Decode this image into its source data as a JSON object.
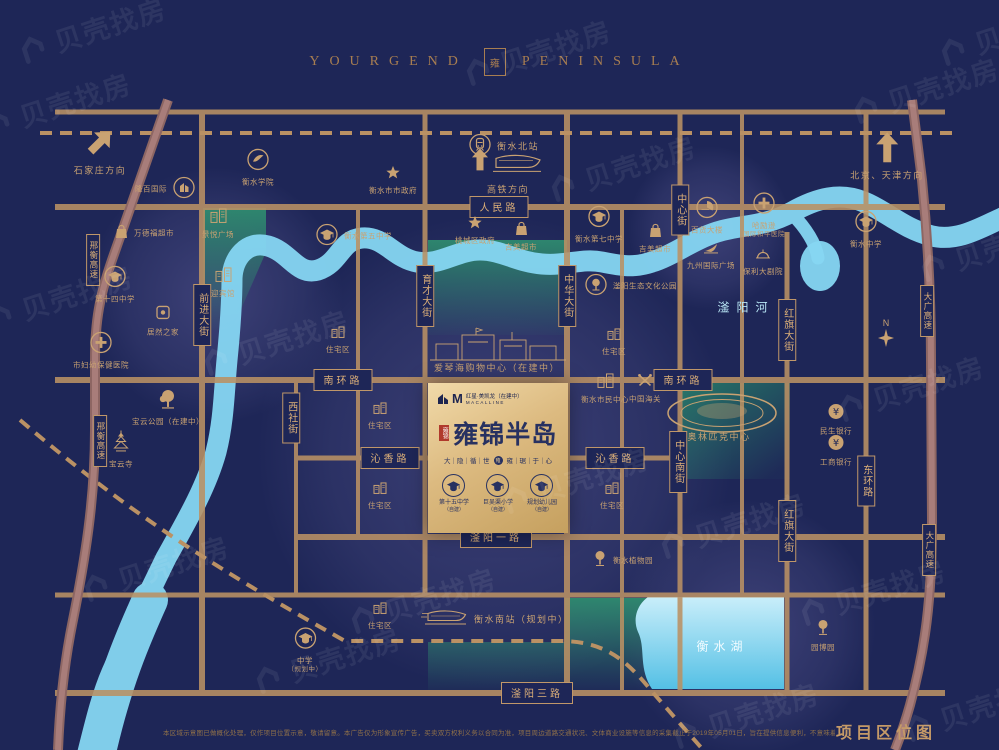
{
  "header": {
    "brand_left": "YOURGEND",
    "seal": "雍",
    "brand_right": "PENINSULA"
  },
  "watermark": {
    "text": "贝壳找房"
  },
  "labels": {
    "river": "滏阳河",
    "lake": "衡水湖",
    "compass_n": "N"
  },
  "roads": {
    "horizontal": [
      {
        "id": "renmin-road",
        "text": "人民路",
        "x": 499,
        "y": 207
      },
      {
        "id": "nanhuan-road-west",
        "text": "南环路",
        "x": 343,
        "y": 380
      },
      {
        "id": "nanhuan-road-east",
        "text": "南环路",
        "x": 683,
        "y": 380
      },
      {
        "id": "qinxiang-road-west",
        "text": "沁香路",
        "x": 390,
        "y": 458
      },
      {
        "id": "qinxiang-road-east",
        "text": "沁香路",
        "x": 615,
        "y": 458
      },
      {
        "id": "fuyang-1st-road",
        "text": "滏阳一路",
        "x": 496,
        "y": 537
      },
      {
        "id": "fuyang-3rd-road",
        "text": "滏阳三路",
        "x": 537,
        "y": 693
      }
    ],
    "vertical": [
      {
        "id": "qianjin-street",
        "text": "前进大街",
        "x": 202,
        "y": 315
      },
      {
        "id": "yucai-street",
        "text": "育才大街",
        "x": 425,
        "y": 296
      },
      {
        "id": "zhonghua-street",
        "text": "中华大街",
        "x": 567,
        "y": 296
      },
      {
        "id": "zhongxin-street",
        "text": "中心街",
        "x": 680,
        "y": 210
      },
      {
        "id": "zhongxin-south-street",
        "text": "中心南街",
        "x": 678,
        "y": 462
      },
      {
        "id": "xishe-street",
        "text": "西社街",
        "x": 291,
        "y": 418
      },
      {
        "id": "hongqi-street-north",
        "text": "红旗大街",
        "x": 787,
        "y": 330
      },
      {
        "id": "hongqi-street-south",
        "text": "红旗大街",
        "x": 787,
        "y": 531
      },
      {
        "id": "donghuan-road",
        "text": "东环路",
        "x": 866,
        "y": 481
      },
      {
        "id": "xingheng-expressway-north",
        "text": "邢衡高速",
        "x": 93,
        "y": 260,
        "expwy": true
      },
      {
        "id": "xingheng-expressway-south",
        "text": "邢衡高速",
        "x": 100,
        "y": 441,
        "expwy": true
      },
      {
        "id": "daguang-expressway-north",
        "text": "大广高速",
        "x": 927,
        "y": 311,
        "expwy": true
      },
      {
        "id": "daguang-expressway-south",
        "text": "大广高速",
        "x": 929,
        "y": 550,
        "expwy": true
      }
    ]
  },
  "pois": [
    {
      "id": "shijiazhuang-direction",
      "icon": "arrow-ne",
      "x": 100,
      "y": 152,
      "label": "石家庄方向",
      "pos": "b",
      "big": true
    },
    {
      "id": "beijing-tianjin-direction",
      "icon": "arrow-up",
      "x": 887,
      "y": 157,
      "label": "北京、天津方向",
      "pos": "b",
      "big": true
    },
    {
      "id": "hengshui-north-station",
      "icon": "train-circle",
      "x": 481,
      "y": 147,
      "label": "衡水北站",
      "pos": "r",
      "big": true
    },
    {
      "id": "hsr-direction",
      "icon": "hsr-art",
      "x": 508,
      "y": 172,
      "label": "高铁方向",
      "pos": "b",
      "big": true
    },
    {
      "id": "hengshui-college",
      "icon": "circle-bird",
      "x": 258,
      "y": 168,
      "label": "衡水学院",
      "pos": "b"
    },
    {
      "id": "longbai-international",
      "icon": "circle-building",
      "x": 183,
      "y": 190,
      "label": "隆百国际",
      "pos": "l"
    },
    {
      "id": "wandefu-supermarket",
      "icon": "bag",
      "x": 127,
      "y": 234,
      "label": "万德福超市",
      "pos": "r"
    },
    {
      "id": "jingyue-plaza",
      "icon": "building",
      "x": 218,
      "y": 224,
      "label": "景悦广场",
      "pos": "b"
    },
    {
      "id": "yingbin-hotel",
      "icon": "building",
      "x": 223,
      "y": 283,
      "label": "迎宾馆",
      "pos": "b"
    },
    {
      "id": "no14-middle-school",
      "icon": "grad-circle",
      "x": 115,
      "y": 285,
      "label": "第十四中学",
      "pos": "b"
    },
    {
      "id": "maternal-health-hospital",
      "icon": "cross-circle",
      "x": 101,
      "y": 351,
      "label": "市妇幼保健医院",
      "pos": "b"
    },
    {
      "id": "juran-home",
      "icon": "square-logo",
      "x": 163,
      "y": 321,
      "label": "居然之家",
      "pos": "b"
    },
    {
      "id": "baoyun-park",
      "icon": "tree-big",
      "x": 168,
      "y": 408,
      "label": "宝云公园（在建中）",
      "pos": "b"
    },
    {
      "id": "baoyun-temple",
      "icon": "pagoda",
      "x": 121,
      "y": 450,
      "label": "宝云寺",
      "pos": "b"
    },
    {
      "id": "city-government",
      "icon": "star",
      "x": 393,
      "y": 181,
      "label": "衡水市市政府",
      "pos": "b"
    },
    {
      "id": "taocheng-government",
      "icon": "star",
      "x": 475,
      "y": 231,
      "label": "桃城区政府",
      "pos": "b"
    },
    {
      "id": "no5-middle-school",
      "icon": "grad-circle",
      "x": 328,
      "y": 237,
      "label": "衡水第五中学",
      "pos": "r"
    },
    {
      "id": "jimei-supermarket-1",
      "icon": "bag",
      "x": 521,
      "y": 237,
      "label": "吉美超市",
      "pos": "b"
    },
    {
      "id": "no7-middle-school",
      "icon": "grad-circle",
      "x": 599,
      "y": 225,
      "label": "衡水第七中学",
      "pos": "b"
    },
    {
      "id": "jimei-supermarket-2",
      "icon": "bag",
      "x": 655,
      "y": 239,
      "label": "吉美超市",
      "pos": "b"
    },
    {
      "id": "fuyang-eco-park",
      "icon": "tree-circle",
      "x": 597,
      "y": 287,
      "label": "滏阳生态文化公园",
      "pos": "r"
    },
    {
      "id": "department-store",
      "icon": "pie-circle",
      "x": 707,
      "y": 216,
      "label": "百货大楼",
      "pos": "b"
    },
    {
      "id": "peace-hospital",
      "icon": "cross-circle",
      "x": 764,
      "y": 216,
      "label": "哈励逊",
      "label2": "国际和平医院",
      "pos": "b"
    },
    {
      "id": "jiuzhou-plaza",
      "icon": "sail",
      "x": 711,
      "y": 256,
      "label": "九州国际广场",
      "pos": "b"
    },
    {
      "id": "poly-theatre",
      "icon": "dome",
      "x": 763,
      "y": 262,
      "label": "保利大剧院",
      "pos": "b"
    },
    {
      "id": "hengshui-middle-school",
      "icon": "grad-circle",
      "x": 866,
      "y": 230,
      "label": "衡水中学",
      "pos": "b"
    },
    {
      "id": "civic-center",
      "icon": "building",
      "x": 605,
      "y": 389,
      "label": "衡水市民中心",
      "pos": "b"
    },
    {
      "id": "china-customs",
      "icon": "crossed",
      "x": 645,
      "y": 389,
      "label": "中国海关",
      "pos": "b"
    },
    {
      "id": "olympic-center",
      "icon": "none",
      "x": 719,
      "y": 437,
      "label": "奥林匹克中心",
      "pos": "b",
      "big": true
    },
    {
      "id": "minsheng-bank",
      "icon": "yen-circle",
      "x": 836,
      "y": 420,
      "label": "民生银行",
      "pos": "b"
    },
    {
      "id": "icbc-bank",
      "icon": "yen-circle",
      "x": 836,
      "y": 451,
      "label": "工商银行",
      "pos": "b"
    },
    {
      "id": "residential-1",
      "icon": "building-sm",
      "x": 338,
      "y": 340,
      "label": "住宅区",
      "pos": "b"
    },
    {
      "id": "residential-2",
      "icon": "building-sm",
      "x": 614,
      "y": 342,
      "label": "住宅区",
      "pos": "b"
    },
    {
      "id": "residential-3",
      "icon": "building-sm",
      "x": 380,
      "y": 416,
      "label": "住宅区",
      "pos": "b"
    },
    {
      "id": "residential-4",
      "icon": "building-sm",
      "x": 380,
      "y": 496,
      "label": "住宅区",
      "pos": "b"
    },
    {
      "id": "residential-5",
      "icon": "building-sm",
      "x": 612,
      "y": 496,
      "label": "住宅区",
      "pos": "b"
    },
    {
      "id": "residential-6",
      "icon": "building-sm",
      "x": 380,
      "y": 616,
      "label": "住宅区",
      "pos": "b"
    },
    {
      "id": "aegean-mall",
      "icon": "none",
      "x": 497,
      "y": 368,
      "label": "爱琴海购物中心（在建中）",
      "pos": "b",
      "big": true
    },
    {
      "id": "hengshui-south-station",
      "icon": "train-art",
      "x": 432,
      "y": 620,
      "label": "衡水南站（规划中）",
      "pos": "r",
      "big": true
    },
    {
      "id": "middle-school-planned",
      "icon": "grad-circle",
      "x": 305,
      "y": 651,
      "label": "中学",
      "label2": "（规划中）",
      "pos": "b"
    },
    {
      "id": "hengshui-botanical-garden",
      "icon": "tree",
      "x": 605,
      "y": 561,
      "label": "衡水植物园",
      "pos": "r"
    },
    {
      "id": "yuanbo-garden",
      "icon": "tree",
      "x": 823,
      "y": 636,
      "label": "园博园",
      "pos": "b"
    }
  ],
  "project": {
    "developer_logo": "M",
    "developer": "红星·美凯龙（在建中）",
    "developer_sub": "MACALLINE",
    "seal_text": "雍锦",
    "name": "雍锦半岛",
    "slogan_left": "大｜隐｜循｜世",
    "slogan_seal": "雍",
    "slogan_right": "雍｜琚｜于｜心",
    "schools": [
      {
        "label": "第十五中学",
        "note": "（自建）"
      },
      {
        "label": "巨吴渠小学",
        "note": "（自建）"
      },
      {
        "label": "规划幼儿园",
        "note": "（自建）"
      }
    ]
  },
  "footer": {
    "disclaimer": "本区域示意图已做概化处理，仅作项目位置示意，敬请留意。本广告仅为形象宣传广告，买卖双方权利义务以合同为准，项目周边道路交通状况、文体商业设施等信息的采集截止于2019年05月01日，旨在提供信息便利，不意味着本公司对此做出承诺，敬请实地查看或了解规划建设情况，制作日期2019年05月21日。",
    "map_title": "项目区位图"
  },
  "colors": {
    "background": "#1e2657",
    "road": "#ba9164",
    "expressway": "#9f7472",
    "river": "#86d6f2",
    "gold_label": "#c9a272",
    "project_navy": "#273161",
    "project_gold": "#e2c489",
    "seal_red": "#b03a2c"
  }
}
